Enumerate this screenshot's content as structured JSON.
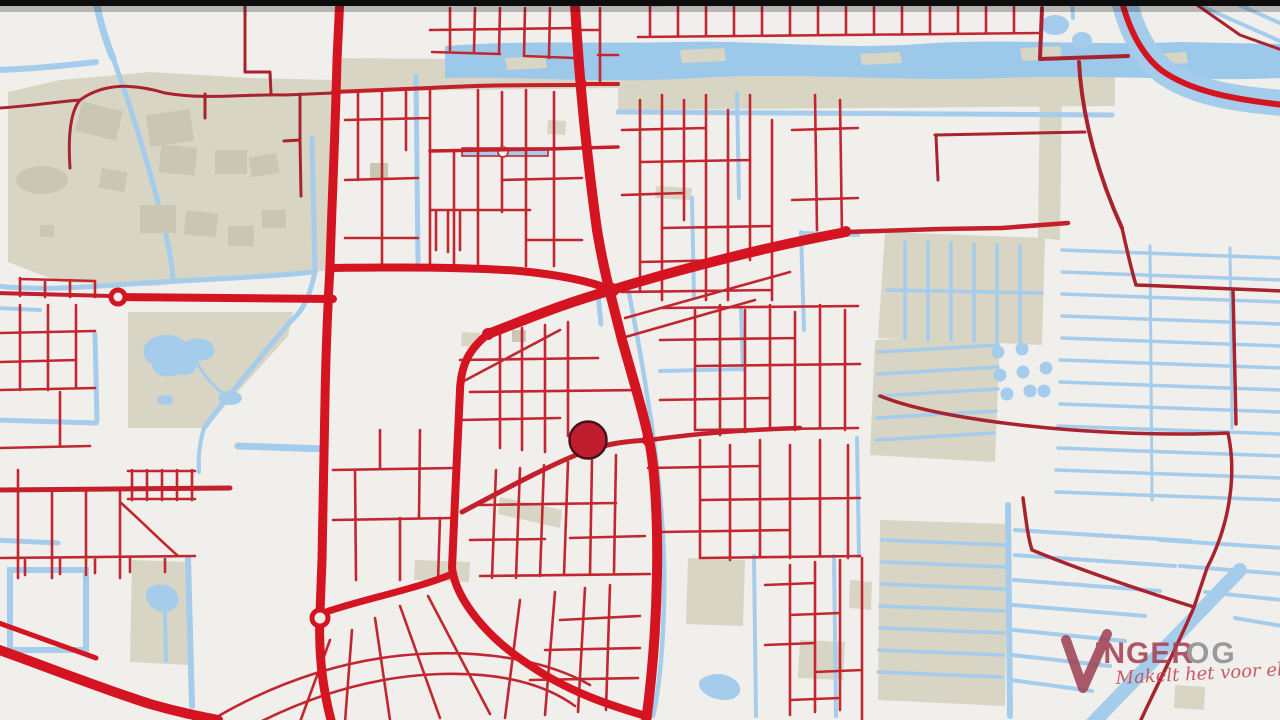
{
  "map": {
    "marker": {
      "cx": 588,
      "cy": 440,
      "r": 18.5
    },
    "colors": {
      "bg": "#f0efec",
      "land": "#d8d5c4",
      "bldg": "#c9c6b3",
      "water": "#a5cdeb",
      "waterBand": "#9cc8ea",
      "roadT": "#d41420",
      "roadM": "#c41f2a",
      "roadm": "#c22731",
      "roadD": "#a8232e",
      "marker": "#c01e2f",
      "markerEdge": "#47101c",
      "topbar": "#0d0d0d",
      "logoMark": "#a04458",
      "logoText": "#a54254",
      "logoGray": "#8e8e90",
      "logoScript": "#c34653"
    }
  },
  "logo": {
    "brand_primary": "INGER",
    "brand_secondary": "OG",
    "tagline": "Makelt het voor elkaar!"
  }
}
